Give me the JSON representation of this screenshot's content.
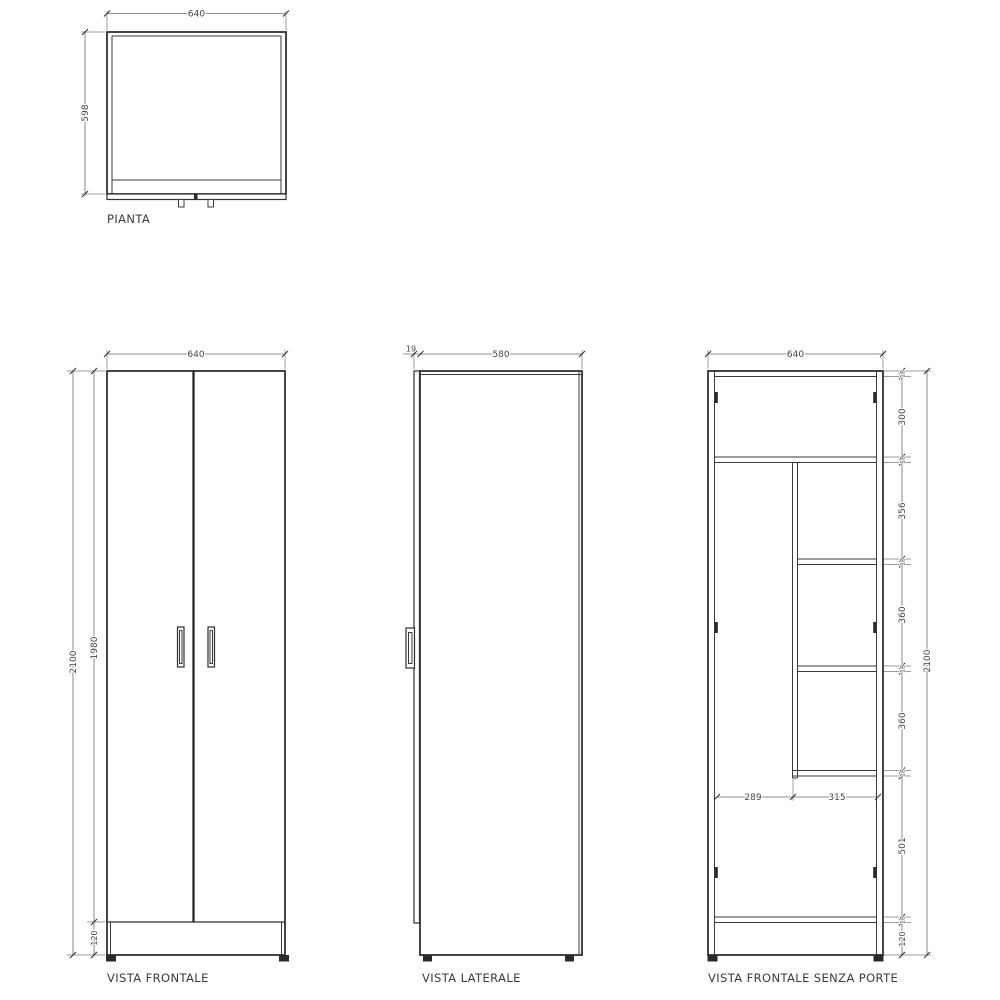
{
  "drawing": {
    "views": {
      "pianta": {
        "label": "PIANTA",
        "width": "640",
        "depth": "598"
      },
      "frontale": {
        "label": "VISTA FRONTALE",
        "width": "640",
        "total_height": "2100",
        "door_height": "1980",
        "plinth_height": "120"
      },
      "laterale": {
        "label": "VISTA LATERALE",
        "door_thickness": "19",
        "depth": "580"
      },
      "senza_porte": {
        "label": "VISTA FRONTALE SENZA PORTE",
        "width": "640",
        "total_height": "2100",
        "panel_thickness": "18",
        "sections": {
          "top": "300",
          "s2": "356",
          "s3": "360",
          "s4": "360",
          "bottom": "501"
        },
        "plinth_height": "120",
        "left_width": "289",
        "right_width": "315"
      }
    }
  }
}
